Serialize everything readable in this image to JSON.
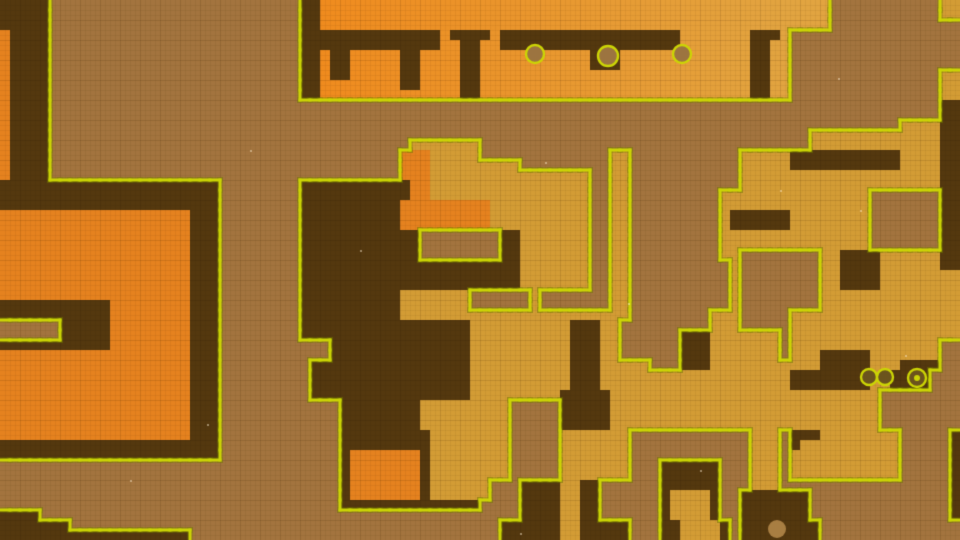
{
  "scene": {
    "type": "tile-map",
    "description": "mine-map-overview",
    "width": 960,
    "height": 540,
    "cell": 10,
    "cols": 96,
    "palette": {
      "fog": "#a3743e",
      "dark": "#54380f",
      "orange": "#e5821f",
      "gold": "#d39c35",
      "strip_left": "#f08a1d",
      "strip_right": "#e2a440",
      "outline": "#ccd505",
      "outline_halo": "rgba(110,115,0,0.30)",
      "grid_line": "rgba(40,20,0,0.05)",
      "grid_line_major": "rgba(40,20,0,0.07)"
    },
    "legend": {
      ".": "fog-rock",
      "D": "dug-tunnel-dark",
      "O": "rock-orange",
      "G": "rock-gold",
      "S": "rock-gradient-strip"
    },
    "rows": [
      "DDDDD.........................DDSSSSSSSSSSSSSSSSSSSSSSSSSSSSSSSSSSSSSSSSSSSSSSSSSSS...........GG",
      "DDDDD.........................DDSSSSSSSSSSSSSSSSSSSSSSSSSSSSSSSSSSSSSSSSSSSSSSSSSSS...........GG",
      "DDDDD.........................DDSSSSSSSSSSSSSSSSSSSSSSSSSSSSSSSSSSSSSSSSSSSSSSSSSSS.............",
      "ODDDD.........................DDDDDDDDDDDDDDSDDDDSDDDDDDDDDDDDDDDDDDSSSSSSSDDDS.................",
      "ODDDD.........................DDDDDDDDDDDDDDSSDDSSDDDDDDDDDDDDDDDDDDSSSSSSSDDSS.................",
      "ODDDD.........................DDSDDSSSSSDDSSSSDDSSSSSSSSSSSDDDSSSSSSSSSSSSSDDSS.................",
      "ODDDD.........................DDSDDSSSSSDDSSSSDDSSSSSSSSSSSDDDSSSSSSSSSSSSSDDSS.................",
      "ODDDD.........................DDSDDSSSSSDDSSSSDDSSSSSSSSSSSSSSSSSSSSSSSSSSSDDSS...............GG",
      "ODDDD.........................DDSSSSSSSSDDSSSSDDSSSSSSSSSSSSSSSSSSSSSSSSSSSDDSS...............GG",
      "ODDDD.........................DDSSSSSSSSSSSSSSDDSSSSSSSSSSSSSSSSSSSSSSSSSSSDDSS...............GG",
      "ODDDD.........................................................................................DD",
      "ODDDD.........................................................................................DD",
      "ODDDD.....................................................................................GGGGDD",
      "ODDDD............................................................................GGGGGGGGGGGGGDD",
      "ODDDD....................................GGGGGGG.................................GGGGGGGGGGGGGDD",
      "ODDDD...................................OOOGGGGG.............GG...........GGGGGDDDDDDDDDDDGGGGDD",
      "ODDDD...................................OOOGGGGGGGGG.........GG...........GGGGGDDDDDDDDDDDGGGGDD",
      "ODDDD...................................OOOGGGGGGGGGGGGGGGG..GG...........GGGGGGGGGGGGGGGGGGGGDD",
      "DDDDDDDDDDDDDDDDDDDDDD........DDDDDDDDDDDOOGGGGGGGGGGGGGGGG..GG...........GGGGGGGGGGGGGGGGGGGGDD",
      "DDDDDDDDDDDDDDDDDDDDDD........DDDDDDDDDDDOOGGGGGGGGGGGGGGGG..GG.........GGGGGGGGGGGGGGG.......DD",
      "DDDDDDDDDDDDDDDDDDDDDD........DDDDDDDDDDOOOOOOOOOGGGGGGGGGG..GG.........GGGGGGGGGGGGGGG.......DD",
      "OOOOOOOOOOOOOOOOOOODDD........DDDDDDDDDDOOOOOOOOOGGGGGGGGGG..GG.........GDDDDDDGGGGGGGG.......DD",
      "OOOOOOOOOOOOOOOOOOODDD........DDDDDDDDDDOOOOOOOOOGGGGGGGGGG..GG.........GDDDDDDGGGGGGGG.......DD",
      "OOOOOOOOOOOOOOOOOOODDD........DDDDDDDDDDDD........DDGGGGGGG..GG.........GGGGGGGGGGGGGGG.......DD",
      "OOOOOOOOOOOOOOOOOOODDD........DDDDDDDDDDDD........DDGGGGGGG..GG.........GGGGGGGGGGGGGGG.......DD",
      "OOOOOOOOOOOOOOOOOOODDD........DDDDDDDDDDDD........DDGGGGGGG..GG.........GG........GGDDDDGGGGGGDD",
      "OOOOOOOOOOOOOOOOOOODDD........DDDDDDDDDDDDDDDDDDDDDDGGGGGGG..GG..........G........GGDDDDGGGGGGDD",
      "OOOOOOOOOOOOOOOOOOODDD........DDDDDDDDDDDDDDDDDDDDDDGGGGGGG..GG..........G........GGDDDDGGGGGGGG",
      "OOOOOOOOOOOOOOOOOOODDD........DDDDDDDDDDDDDDDDDDDDDDGGGGGGG..GG..........G........GGDDDDGGGGGGGG",
      "OOOOOOOOOOOOOOOOOOODDD........DDDDDDDDDDGGGGGGG......G.......GG..........G........GGGGGGGGGGGGGG",
      "DDDDDDDDDDDOOOOOOOODDD........DDDDDDDDDDGGGGGGG......G.......GG..........G........GGGGGGGGGGGGGG",
      "DDDDDDDDDDDOOOOOOOODDD........DDDDDDDDDDGGGGGGGGGGGGGGGGGGGGGGG........GGG.....GGGGGGGGGGGGGGGGG",
      "......DDDDDOOOOOOOODDD........DDDDDDDDDDDDDDDDDGGGGGGGGGGDDDGG.........GGG.....GGGGGGGGGGGGGGGGG",
      "......DDDDDOOOOOOOODDD........DDDDDDDDDDDDDDDDDGGGGGGGGGGDDDGG......DDDGGGGGGG.GGGGGGGGGGGGGGGGG",
      "DDDDDDDDDDDOOOOOOOODDD...........DDDDDDDDDDDDDDGGGGGGGGGGDDDGG......DDDGGGGGGG.GGGGGGGGGGGGGGG..",
      "OOOOOOOOOOOOOOOOOOODDD...........DDDDDDDDDDDDDDGGGGGGGGGGDDDGG......DDDGGGGGGG.GGGDDDDDGGGGGGG..",
      "OOOOOOOOOOOOOOOOOOODDD.........DDDDDDDDDDDDDDDDGGGGGGGGGGDDDGGGGG...DDDGGGGGGGGGGGDDDDDGGGDDDD..",
      "OOOOOOOOOOOOOOOOOOODDD.........DDDDDDDDDDDDDDDDGGGGGGGGGGDDDGGGGGGGGGGGGGGGGGGGDDDDDDDDGGDDDD...",
      "OOOOOOOOOOOOOOOOOOODDD.........DDDDDDDDDDDDDDDDGGGGGGGGGGDDDGGGGGGGGGGGGGGGGGGGDDDDDDDDGGDDDD...",
      "OOOOOOOOOOOOOOOOOOODDD.........DDDDDDDDDDDDDDDDGGGGGGGGGDDDDDGGGGGGGGGGGGGGGGGGGGGGGGGGG......",
      "OOOOOOOOOOOOOOOOOOODDD............DDDDDDDDGGGGGGGGG.....DDDDDGGGGGGGGGGGGGGGGGGGGGGGGGGG......",
      "OOOOOOOOOOOOOOOOOOODDD............DDDDDDDDGGGGGGGGG.....DDDDDGGGGGGGGGGGGGGGGGGGGGGGGGGG......",
      "OOOOOOOOOOOOOOOOOOODDD............DDDDDDDDGGGGGGGGG.....DDDDDGGGGGGGGGGGGGGGGGGGGGGGGGGG......",
      "OOOOOOOOOOOOOOOOOOODDD............DDDDDDDDDGGGGGGGG.....GGGGGGG............GGG.DDDGGGGGGGG.....D",
      "DDDDDDDDDDDDDDDDDDDDDD............DDDDDDDDDGGGGGGGG.....GGGGGGG............GGG.DGGGGGGGGGG.....D",
      "DDDDDDDDDDDDDDDDDDDDDD............DOOOOOOODGGGGGGGG.....GGGGGGG............GGG.GGGGGGGGGGG.....D",
      "..................................DOOOOOOODGGGGGGGG.....GGGGGGG...DDDDDD...GGG.GGGGGGGGGGG.....D",
      "..................................DOOOOOOODGGGGGGGG.....GGGGGGG...DDDDDD...GGG.GGGGGGGGGGG.....D",
      "..................................DOOOOOOODGGGGGG...DDDDGGDD......DDDDDD...GGG.................D",
      "..................................DOOOOOOODGGGGGG...DDDDGGDD......DGGGGD..DDDDDDD..............D",
      "..................................DDDDDDDDDDDDDD....DDDDGGDD......DGGGGD..DDDDDDD..............D",
      "DDDD................................................DDDDGGDD......DGGGGD..DDDDDDD..............D",
      "DDDDDDD...........................................DDDDDDGGDDDDD...DDGGGGD.DDDDDDDD..............D",
      "DDDDDDDDDDDDDDDDDDD...............................DDDDDDGGDDDDD...DDGGGGD.DDDDDDDD..............D"
    ],
    "resource_nodes": [
      {
        "x": 535,
        "y": 54,
        "r": 9,
        "fill": "#9c7440",
        "ring": true,
        "dot": false
      },
      {
        "x": 608,
        "y": 56,
        "r": 10,
        "fill": "#9c7440",
        "ring": true,
        "dot": false
      },
      {
        "x": 682,
        "y": 54,
        "r": 9,
        "fill": "#9c7440",
        "ring": true,
        "dot": false
      },
      {
        "x": 869,
        "y": 377,
        "r": 8,
        "fill": "#6b531d",
        "ring": true,
        "dot": false
      },
      {
        "x": 885,
        "y": 377,
        "r": 8,
        "fill": "#6b531d",
        "ring": true,
        "dot": false
      },
      {
        "x": 917,
        "y": 378,
        "r": 9,
        "fill": "#6b531d",
        "ring": true,
        "dot": true
      },
      {
        "x": 777,
        "y": 529,
        "r": 9,
        "fill": "#a87e42",
        "ring": false,
        "dot": false
      }
    ],
    "specks": [
      [
        207,
        424
      ],
      [
        545,
        162
      ],
      [
        838,
        78
      ],
      [
        780,
        190
      ],
      [
        628,
        303
      ],
      [
        520,
        533
      ],
      [
        130,
        480
      ],
      [
        905,
        355
      ],
      [
        250,
        150
      ],
      [
        700,
        470
      ],
      [
        860,
        210
      ],
      [
        360,
        250
      ]
    ],
    "grid": {
      "minor_step": 5,
      "major_step": 20
    }
  }
}
